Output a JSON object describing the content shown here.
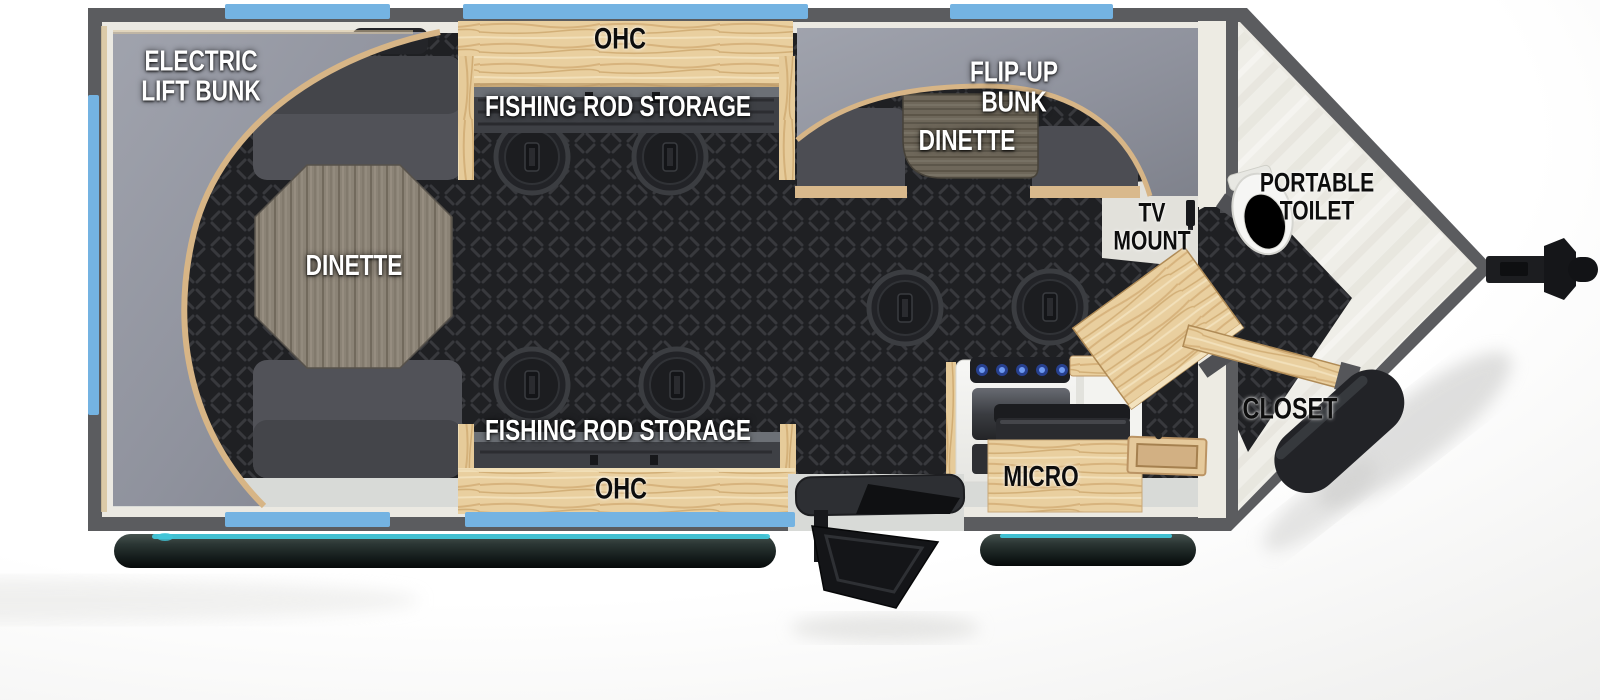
{
  "floorplan": {
    "labels": {
      "electric_lift_bunk": {
        "line1": "ELECTRIC",
        "line2": "LIFT BUNK"
      },
      "ohc_top": "OHC",
      "fishing_rod_storage_top": "FISHING ROD STORAGE",
      "flip_up_bunk": {
        "line1": "FLIP-UP",
        "line2": "BUNK"
      },
      "dinette_front": "DINETTE",
      "dinette_rear": "DINETTE",
      "tv_mount": {
        "line1": "TV",
        "line2": "MOUNT"
      },
      "portable_toilet": {
        "line1": "PORTABLE",
        "line2": "TOILET"
      },
      "micro": "MICRO",
      "closet": "CLOSET",
      "fishing_rod_storage_bottom": "FISHING ROD STORAGE",
      "ohc_bottom": "OHC"
    },
    "features": {
      "fish_hole_count": 6,
      "window_count": 6,
      "entry_step": true,
      "hitch": true
    },
    "colors": {
      "wall": "#5b5c5f",
      "window_blue": "#74b3e2",
      "floor_dark": "#202124",
      "floor_light": "#d8dad7",
      "wood": "#e9cf9f",
      "bunk_gray": "#8f929d",
      "seat_gray": "#515258",
      "teal_accent": "#41c6d9"
    }
  }
}
